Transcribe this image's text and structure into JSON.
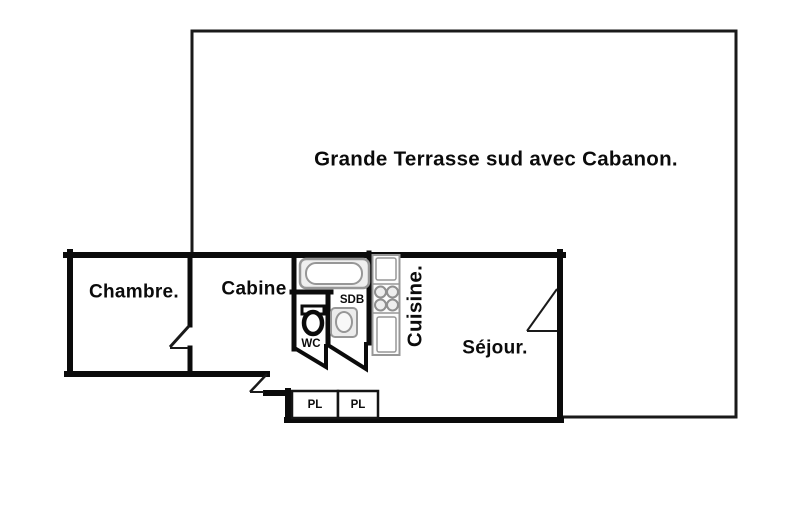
{
  "plan": {
    "title": "Apartment floor plan",
    "terrace": {
      "label": "Grande Terrasse sud avec Cabanon."
    },
    "rooms": {
      "chambre": {
        "label": "Chambre."
      },
      "cabine": {
        "label": "Cabine"
      },
      "sdb": {
        "label": "SDB"
      },
      "wc": {
        "label": "WC"
      },
      "cuisine": {
        "label": "Cuisine."
      },
      "sejour": {
        "label": "Séjour."
      },
      "closet_left": {
        "label": "PL"
      },
      "closet_right": {
        "label": "PL"
      }
    },
    "colors": {
      "wall": "#0b0b0b",
      "fixture_outline": "#979797",
      "background": "#ffffff"
    }
  }
}
